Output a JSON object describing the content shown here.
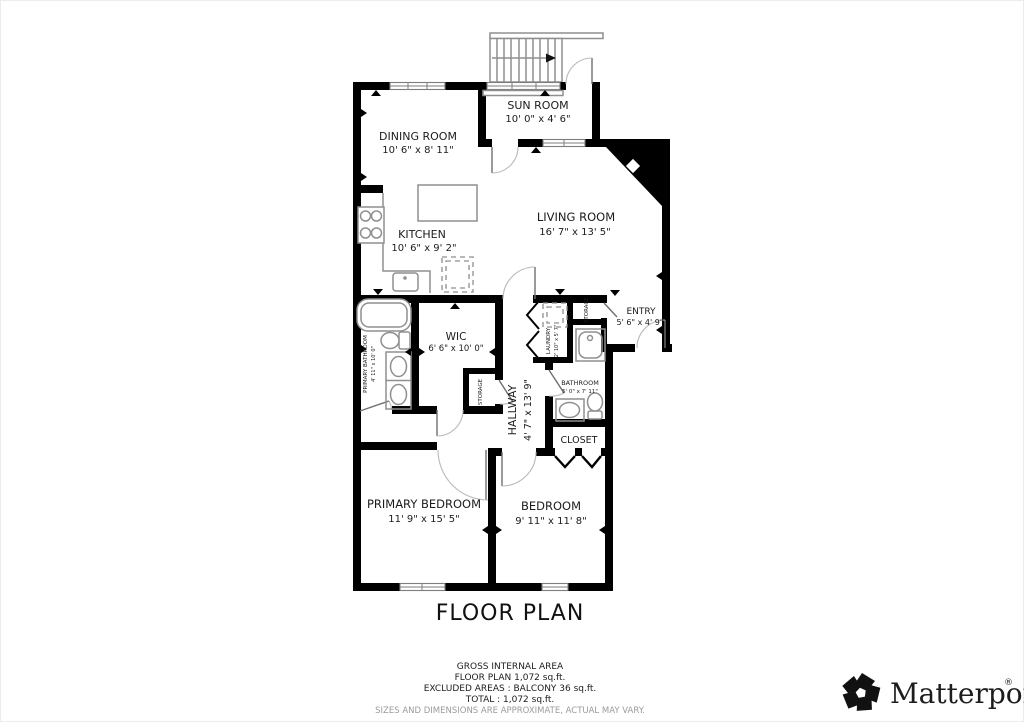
{
  "title": "FLOOR PLAN",
  "rooms": {
    "dining": {
      "name": "DINING ROOM",
      "dims": "10' 6\" x 8' 11\""
    },
    "sun": {
      "name": "SUN ROOM",
      "dims": "10' 0\" x 4' 6\""
    },
    "kitchen": {
      "name": "KITCHEN",
      "dims": "10' 6\" x 9' 2\""
    },
    "living": {
      "name": "LIVING ROOM",
      "dims": "16' 7\" x 13' 5\""
    },
    "entry": {
      "name": "ENTRY",
      "dims": "5' 6\" x 4' 9\""
    },
    "wic": {
      "name": "WIC",
      "dims": "6' 6\" x 10' 0\""
    },
    "hallway": {
      "name": "HALLWAY",
      "dims": "4' 7\" x 13' 9\""
    },
    "laundry": {
      "name": "LAUNDRY",
      "dims": "2' 10\" x 5' 7\""
    },
    "storage_left": {
      "name": "STORAGE"
    },
    "storage_right": {
      "name": "STORAGE"
    },
    "primary_bathroom": {
      "name": "PRIMARY BATHROOM",
      "dims": "4' 11\" x 10' 0\""
    },
    "bathroom": {
      "name": "BATHROOM",
      "dims": "5' 0\" x 7' 11\""
    },
    "closet": {
      "name": "CLOSET"
    },
    "primary_bedroom": {
      "name": "PRIMARY BEDROOM",
      "dims": "11' 9\" x 15' 5\""
    },
    "bedroom": {
      "name": "BEDROOM",
      "dims": "9' 11\" x 11' 8\""
    }
  },
  "footer": {
    "lines": [
      "GROSS INTERNAL AREA",
      "FLOOR PLAN 1,072 sq.ft.",
      "EXCLUDED AREAS :  BALCONY 36 sq.ft.",
      "TOTAL :  1,072 sq.ft."
    ],
    "disclaimer": "SIZES AND DIMENSIONS ARE APPROXIMATE, ACTUAL MAY VARY."
  },
  "branding": {
    "logo_text": "Matterport",
    "registered": "®"
  },
  "colors": {
    "wall": "#000000",
    "fixture": "#8f8f8f",
    "text": "#1c1c1c",
    "disclaimer": "#9b9b9b"
  }
}
